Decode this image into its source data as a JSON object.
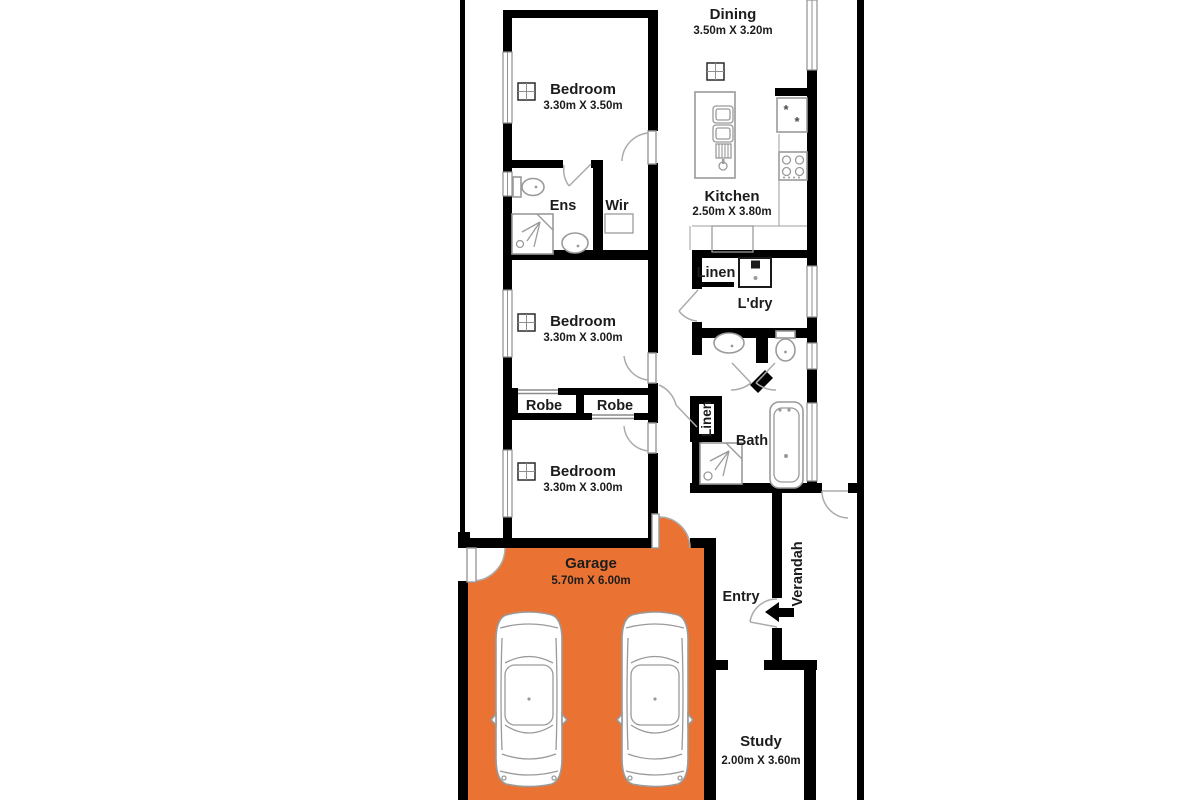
{
  "plan": {
    "title": "Single storey residence floor plan",
    "colors": {
      "garage_fill": "#EA7334",
      "wall": "#000000",
      "text": "#1C1C1C",
      "fixture_line": "#9A9A9A",
      "background": "#FFFFFF"
    },
    "rooms": {
      "dining": {
        "name": "Dining",
        "dims": "3.50m X 3.20m"
      },
      "bedroom1": {
        "name": "Bedroom",
        "dims": "3.30m X 3.50m"
      },
      "kitchen": {
        "name": "Kitchen",
        "dims": "2.50m X 3.80m"
      },
      "ens": {
        "name": "Ens"
      },
      "wir": {
        "name": "Wir"
      },
      "linen_laundry": {
        "name": "Linen"
      },
      "ldry": {
        "name": "L'dry"
      },
      "bedroom2": {
        "name": "Bedroom",
        "dims": "3.30m X 3.00m"
      },
      "robe1": {
        "name": "Robe"
      },
      "robe2": {
        "name": "Robe"
      },
      "linen_bath": {
        "name": "Linen"
      },
      "bath": {
        "name": "Bath"
      },
      "bedroom3": {
        "name": "Bedroom",
        "dims": "3.30m X 3.00m"
      },
      "garage": {
        "name": "Garage",
        "dims": "5.70m X 6.00m"
      },
      "entry": {
        "name": "Entry"
      },
      "verandah": {
        "name": "Verandah"
      },
      "study": {
        "name": "Study",
        "dims": "2.00m X 3.60m"
      }
    },
    "icons": {
      "fridge_marks": "*"
    }
  }
}
